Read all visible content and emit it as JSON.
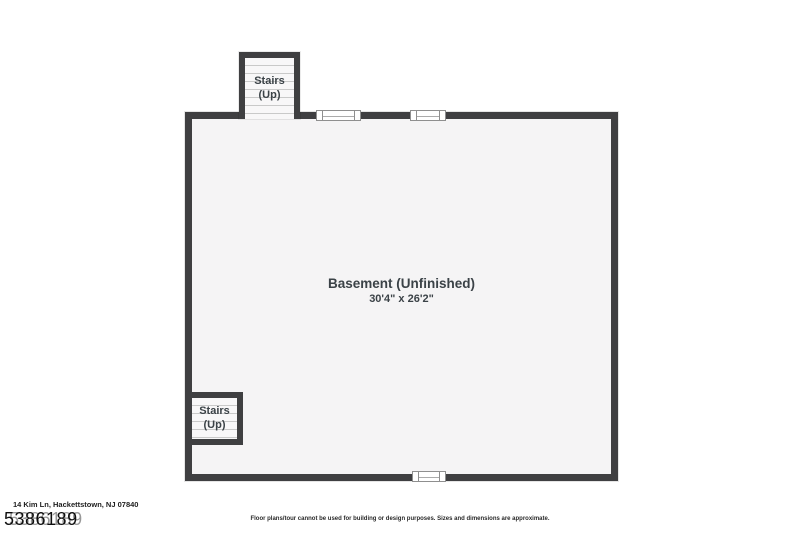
{
  "floorplan": {
    "room": {
      "label": "Basement (Unfinished)",
      "dimensions": "30'4\" x 26'2\""
    },
    "stairs_top": {
      "line1": "Stairs",
      "line2": "(Up)"
    },
    "stairs_bottom": {
      "line1": "Stairs",
      "line2": "(Up)"
    },
    "windows": {
      "top_count": 2,
      "bottom_count": 1,
      "symbol": "double-pane-window"
    }
  },
  "footer": {
    "address": "14 Kim Ln, Hackettstown, NJ 07840",
    "listing_number": "5386189",
    "disclaimer": "Floor plans/tour cannot be used for building or design purposes. Sizes and dimensions are approximate."
  },
  "colors": {
    "wall": "#3f3f41",
    "room_fill": "#f5f4f5",
    "tread_line": "#c9c9c9",
    "label_text": "#3b4247",
    "background": "#ffffff"
  }
}
